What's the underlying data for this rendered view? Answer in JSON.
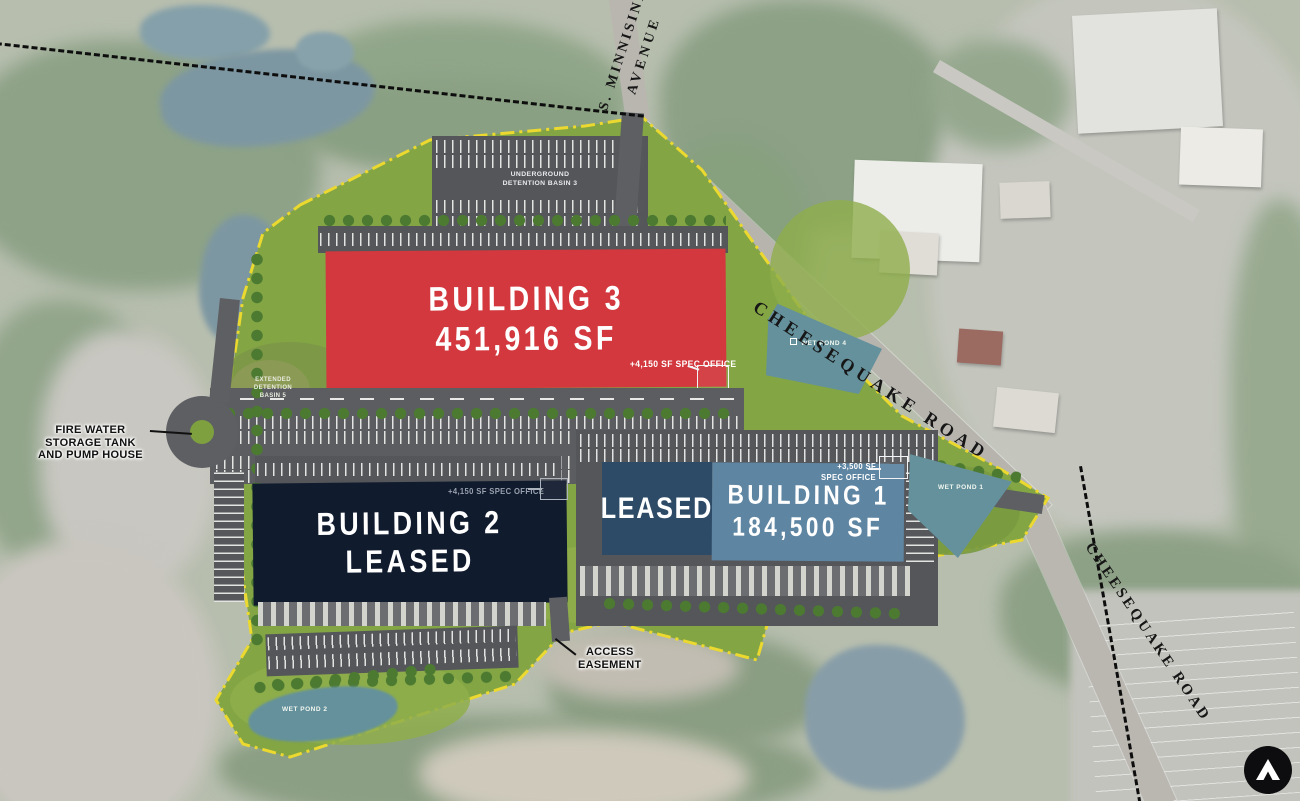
{
  "roads": {
    "s_minnisink": {
      "line1": "S. MINNISINK",
      "line2": "AVENUE"
    },
    "cheesequake_upper": "CHEESEQUAKE ROAD",
    "cheesequake_lower": "CHEESEQUAKE ROAD"
  },
  "buildings": {
    "b3": {
      "title": "BUILDING 3",
      "size": "451,916 SF",
      "spec_note": "+4,150 SF SPEC OFFICE",
      "color": "#d2383d"
    },
    "b2": {
      "title": "BUILDING 2",
      "status": "LEASED",
      "spec_note": "+4,150 SF SPEC OFFICE",
      "color": "#101b2e"
    },
    "b1": {
      "title": "BUILDING 1",
      "size": "184,500 SF",
      "leased_label": "LEASED",
      "spec_note_line1": "+3,500 SF",
      "spec_note_line2": "SPEC OFFICE",
      "color": "#5e85a2",
      "leased_color": "#2d4b66"
    }
  },
  "site_features": {
    "underground_basin": {
      "line1": "UNDERGROUND",
      "line2": "DETENTION BASIN 3"
    },
    "extended_basin": {
      "line1": "EXTENDED",
      "line2": "DETENTION",
      "line3": "BASIN 5"
    },
    "fire_water": {
      "line1": "FIRE WATER",
      "line2": "STORAGE TANK",
      "line3": "AND PUMP HOUSE"
    },
    "access_easement": {
      "line1": "ACCESS",
      "line2": "EASEMENT"
    },
    "wet_pond_1": "WET POND 1",
    "wet_pond_2": "WET POND 2",
    "wet_pond_4": "WET POND 4"
  },
  "branding": {
    "logo_icon": "north-arrow-chevron"
  },
  "colors": {
    "site_green": "#83a544",
    "boundary_yellow": "#ecd92f",
    "parking_gray": "#54565a",
    "pond_teal": "#6a8f9a"
  }
}
